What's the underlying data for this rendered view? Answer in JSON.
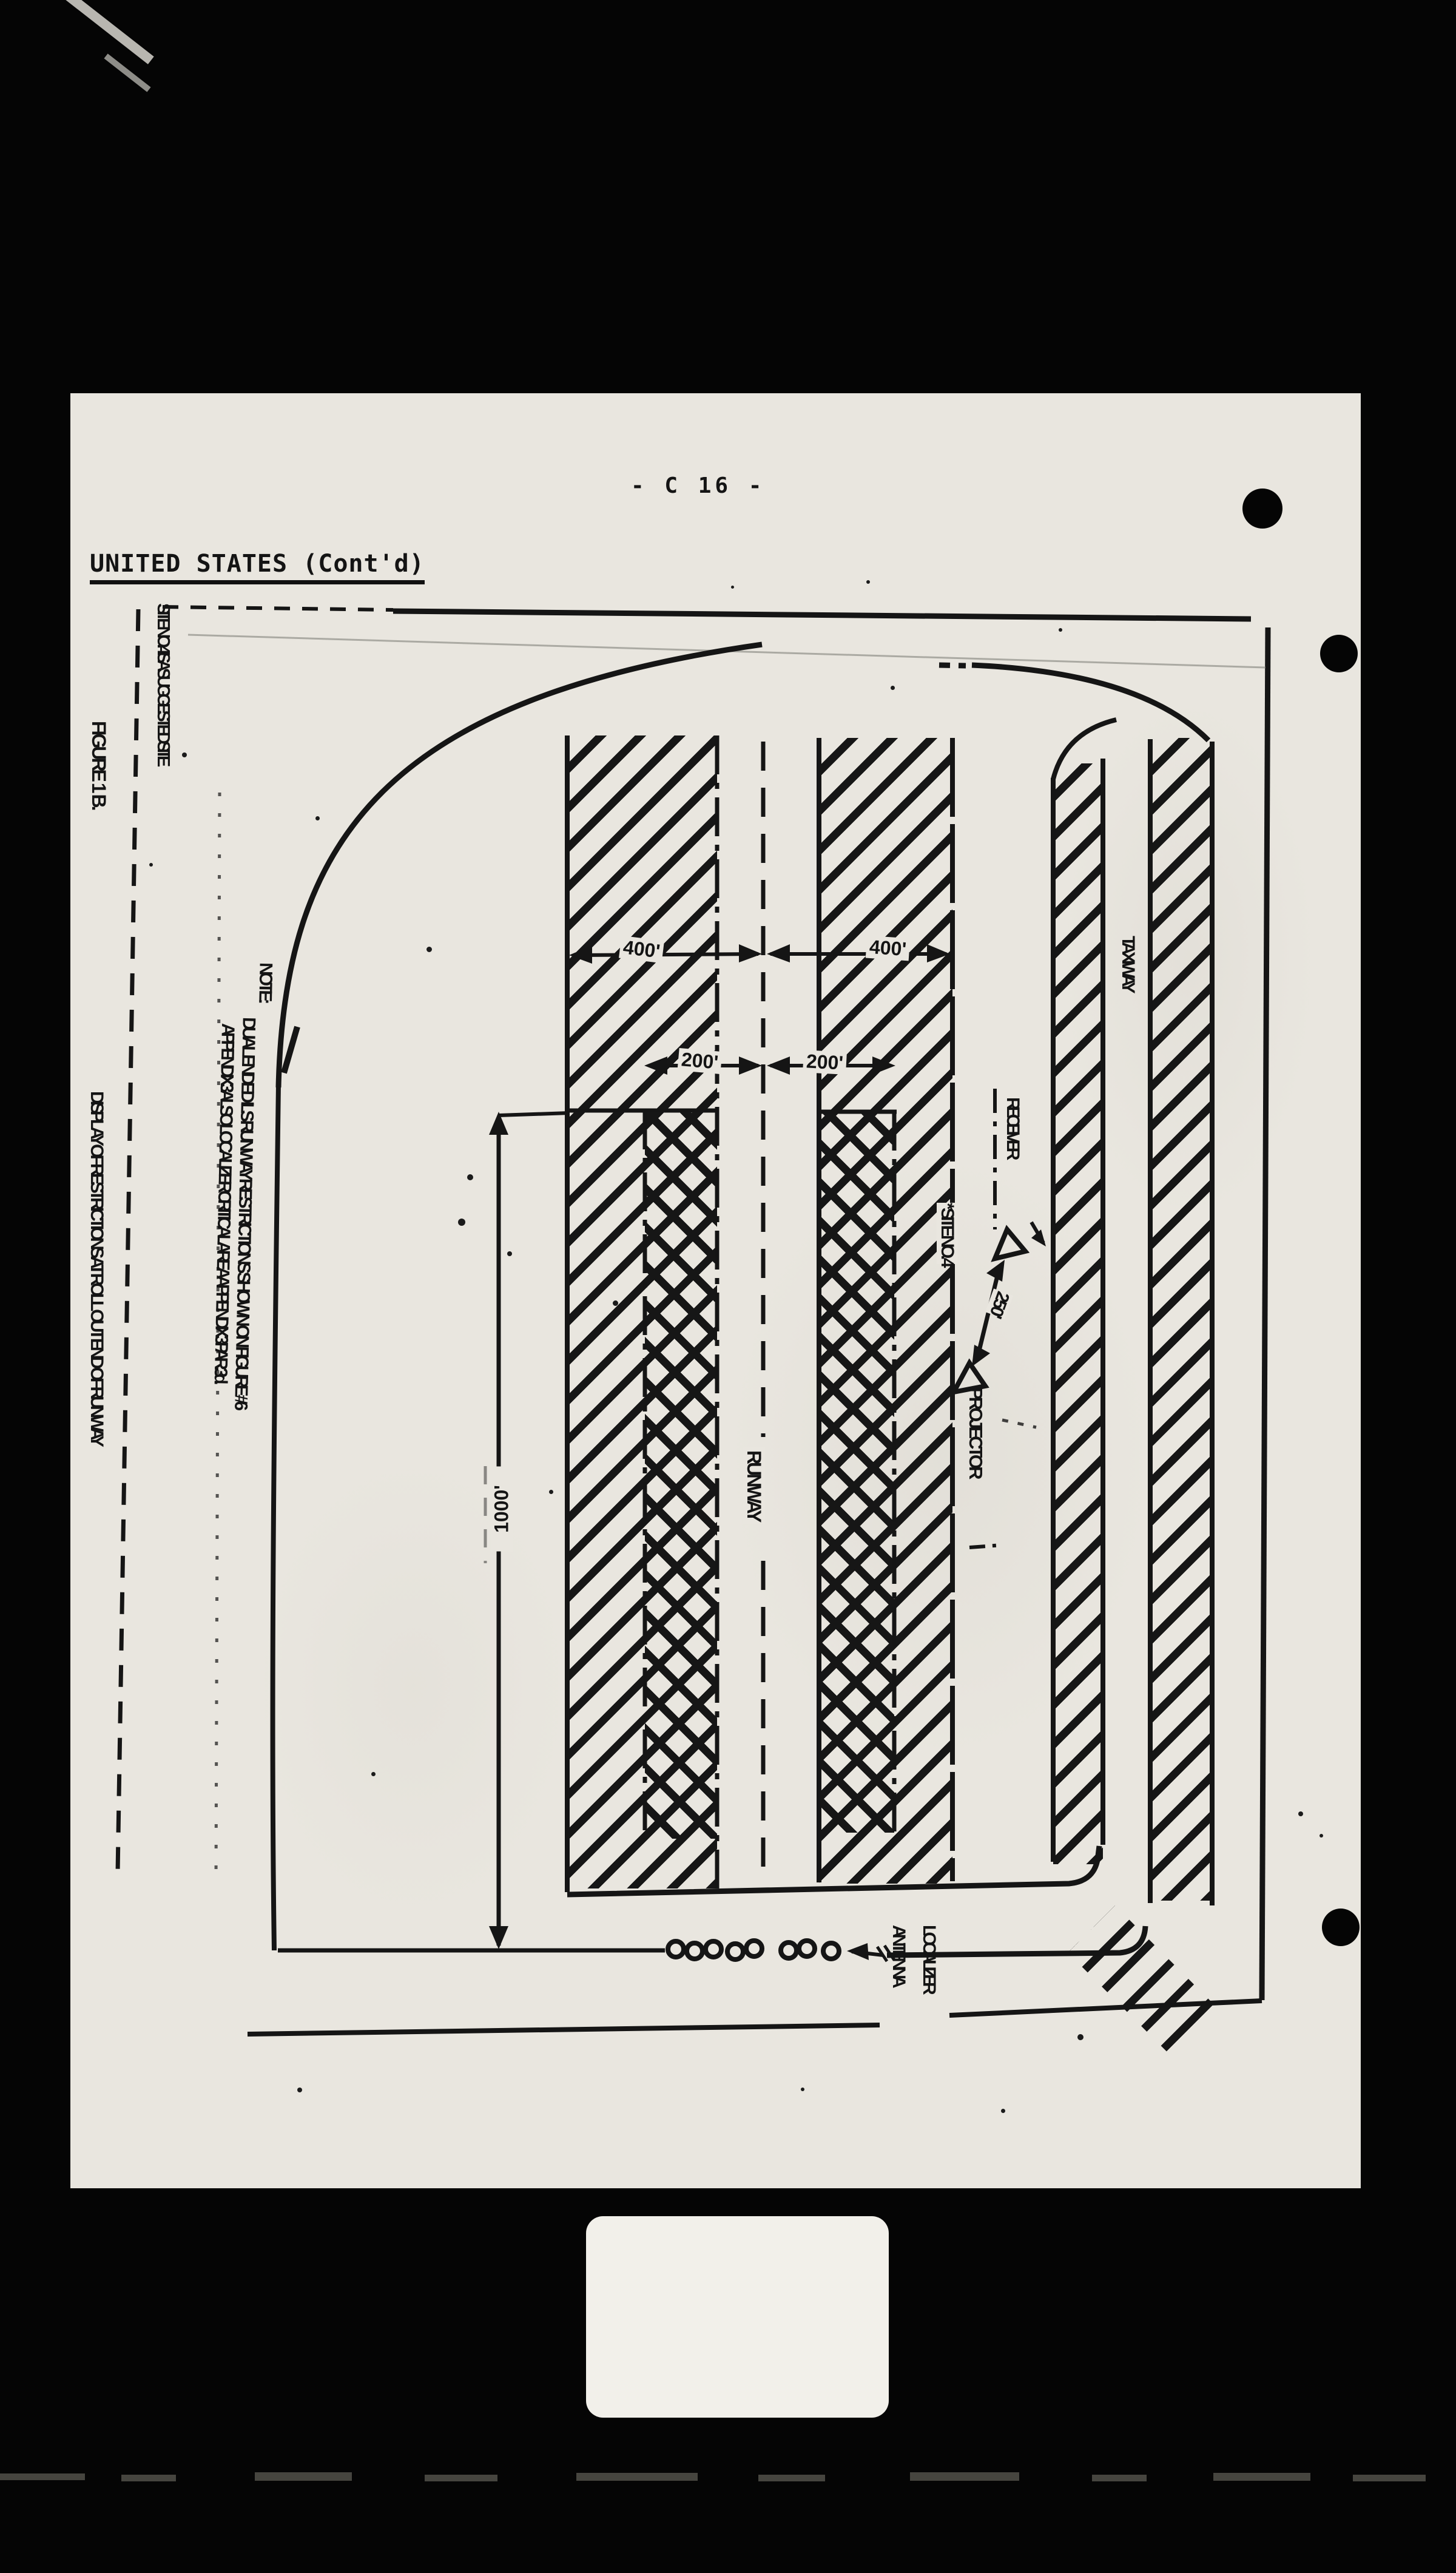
{
  "header": {
    "page_number": "- C 16 -",
    "section": "UNITED STATES (Cont'd)"
  },
  "figure": {
    "number": "FIGURE 1 B.",
    "title": "DISPLAY OF RESTRICTIONS AT ROLL OUT END OF RUNWAY",
    "margin_note": "SITE NO. 4 IS A SUGGESTED SITE",
    "note": {
      "heading": "NOTE:",
      "line1": "DUAL ENDED ILS RUNWAY RESTRICTIONS SHOWN ON FIGURE #6",
      "line2": "APPENDIX 3 ALSO LOCALIZER CRITICAL AREA APPENDIX 3 PAR. 3d."
    },
    "labels": {
      "runway": "RUNWAY",
      "taxiway": "TAXIWAY",
      "receiver": "RECEIVER",
      "projector": "PROJECTOR",
      "site": "* SITE NO. 4",
      "localizer_line1": "LOCALIZER",
      "localizer_line2": "ANTENNA"
    },
    "dimensions": {
      "width_outer": "400'",
      "width_inner": "200'",
      "localizer_distance": "1000'",
      "site_offset": "250'"
    },
    "antenna_element_count": 8,
    "colors": {
      "paper": "#e9e6df",
      "ink": "#151515"
    }
  }
}
